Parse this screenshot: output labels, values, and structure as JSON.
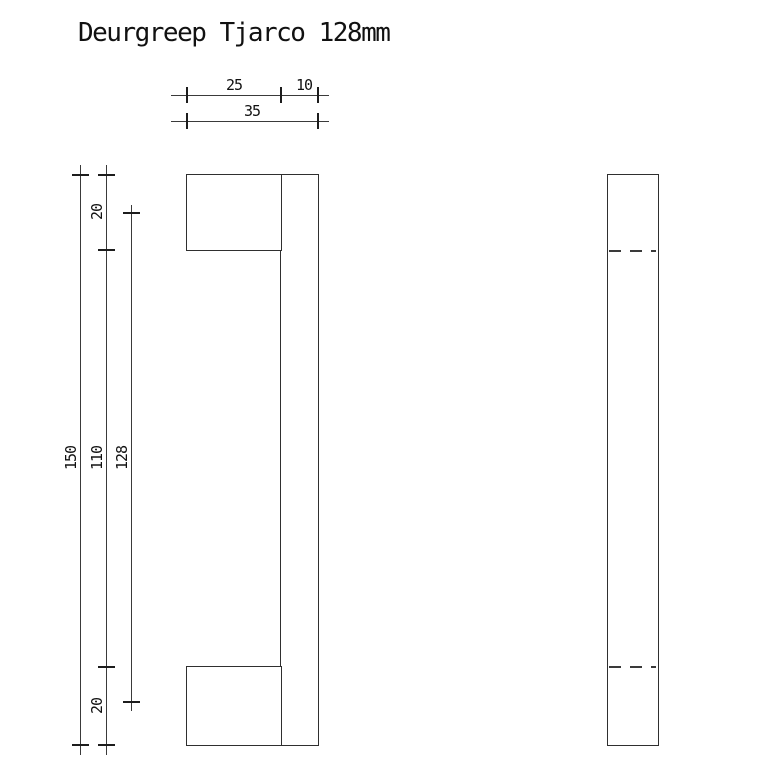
{
  "title": "Deurgreep Tjarco 128mm",
  "colors": {
    "background": "#ffffff",
    "outline": "#2f2f2f",
    "dimension_line": "#3a3a3a",
    "text": "#111111"
  },
  "dimensions": {
    "top": {
      "segment_left": "25",
      "segment_right": "10",
      "total_width": "35"
    },
    "left": {
      "total_height": "150",
      "top_mount_height": "20",
      "between_mounts": "110",
      "bottom_mount_height": "20",
      "mount_center_spacing": "128"
    }
  }
}
